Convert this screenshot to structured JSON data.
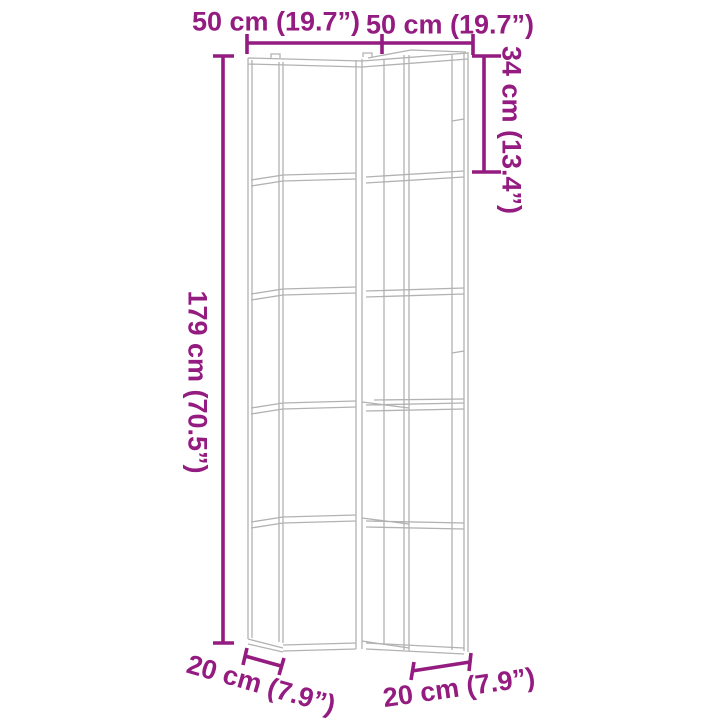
{
  "diagram": {
    "kind": "furniture-dimension-line-drawing",
    "subject": "5-tier corner bookshelf",
    "background_color": "#ffffff",
    "drawing_line_color": "#b2b2b2",
    "dimension_color": "#941b80",
    "labels": {
      "top_width_left": "50 cm (19.7”)",
      "top_width_right": "50 cm (19.7”)",
      "right_height": "34 cm (13.4”)",
      "left_height": "179 cm (70.5”)",
      "bottom_depth_left": "20 cm (7.9”)",
      "bottom_depth_right": "20 cm (7.9”)"
    }
  }
}
